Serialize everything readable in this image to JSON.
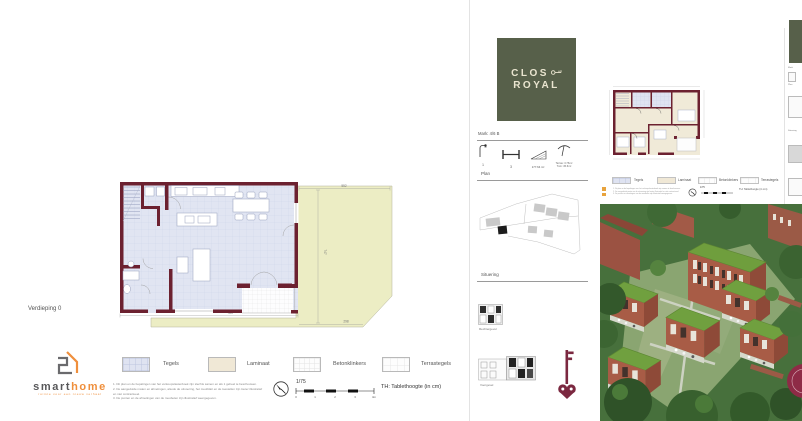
{
  "sheet1": {
    "floor_label": "Verdieping 0",
    "brand": {
      "word1": "smart",
      "word2": "home",
      "tagline": "ruimte voor een nieuw verhaal"
    },
    "legend": [
      {
        "label": "Tegels"
      },
      {
        "label": "Laminaat"
      },
      {
        "label": "Betonklinkers"
      },
      {
        "label": "Terrastegels"
      }
    ],
    "notes": [
      "1. Dit plan en de bepalingen van het verkoopslastenboek zijn slechts samen en als 1 geheel te beschouwen.",
      "2. De aangeduide maten en afmetingen, alsook de uitvoering, het meubilair en de toestellen zijn louter illustratief",
      "en niet contractueel.",
      "3. De punten en de afmetingen van de meubelen zijn illustratief weergegeven."
    ],
    "scale": {
      "ratio": "1/75",
      "tick0": "0",
      "tick1": "1",
      "tick2": "2",
      "tick3": "3",
      "tick4": "4m"
    },
    "th_note": "TH:  Tablethoogte (in cm)",
    "dims": {
      "garden_top": "552",
      "garden_right": "747",
      "garden_bottom": "298",
      "plan_bottom": "784",
      "terrace": "560",
      "terrace_h": "140",
      "living": "838"
    }
  },
  "titleblock": {
    "logo": {
      "line1": "CLOS",
      "line2": "ROYAL"
    },
    "mark": "Mark: 4/6 B",
    "stats": [
      {
        "value": "1"
      },
      {
        "value": "3"
      },
      {
        "value": "177.64 m²"
      },
      {
        "value": "Terras: 3.76m²",
        "value2": "Tuin: 45.6m²"
      }
    ],
    "plan_label": "Plan",
    "situering_label": "Situering",
    "facade_right_label": "Rechtergevel",
    "facade_front_label": "Voorgevel"
  },
  "sheet2": {
    "legend": [
      {
        "label": "Tegels"
      },
      {
        "label": "Laminaat"
      },
      {
        "label": "Betonklinkers"
      },
      {
        "label": "Terrastegels"
      }
    ],
    "notes": [
      "1. Dit plan en de bepalingen van het verkoopslastenboek zijn samen te beschouwen.",
      "2. De aangeduide maten en de uitvoering zijn louter illustratief en niet contractueel.",
      "3. De punten en afmetingen van de meubelen zijn illustratief weergegeven."
    ],
    "scale_ratio": "1/75",
    "th_note": "TH:  Tablethoogte (in cm)",
    "mini_titleblock": {
      "mark": "Mark",
      "plan": "Plan",
      "situering": "Situering"
    }
  },
  "colors": {
    "wall_maroon": "#6c2130",
    "tile_blue": "#e1e5f2",
    "laminate_beige": "#f0e8d6",
    "garden_green": "#ecedc4",
    "logo_green": "#57604a",
    "logo_cream": "#eae5d0",
    "brand_orange": "#ef8f3c",
    "brand_gray": "#58585a",
    "key_maroon": "#7b2840",
    "roof_green": "#6f9e3d",
    "brick_red": "#a85c46"
  }
}
